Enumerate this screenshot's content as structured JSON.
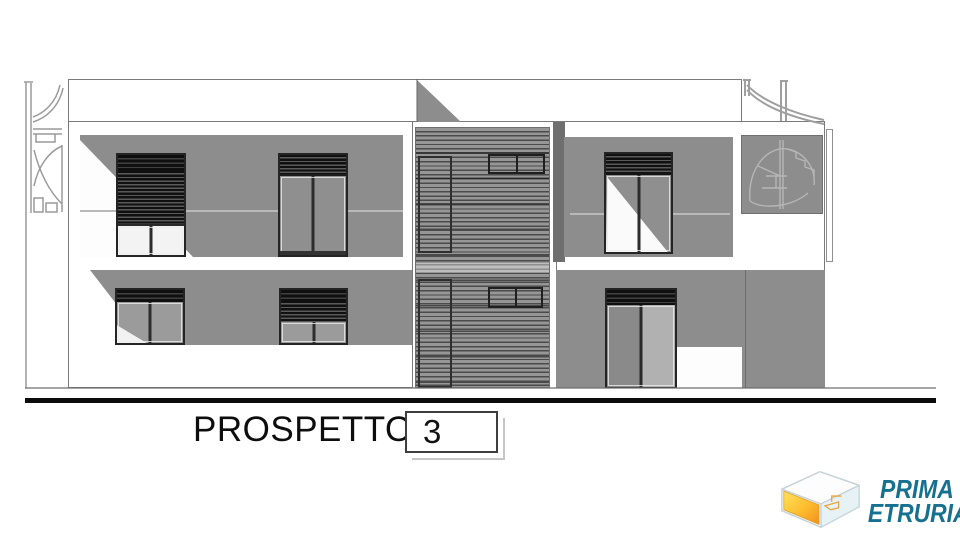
{
  "drawing": {
    "title_label": "PROSPETTO",
    "title_number": "3"
  },
  "logo": {
    "line1": "PRIMA",
    "line2": "ETRURIA",
    "text_color": "#16708f",
    "icon_yellow": "#ffdf55",
    "icon_orange": "#f49d1d",
    "icon_outline": "#c6d2d8"
  },
  "palette": {
    "background": "#ffffff",
    "shadow_gray": "#8d8d8d",
    "pilaster_gray": "#6f6f6f",
    "linework_gray": "#9a9a9a",
    "ground_line_black": "#0b0b0b"
  }
}
